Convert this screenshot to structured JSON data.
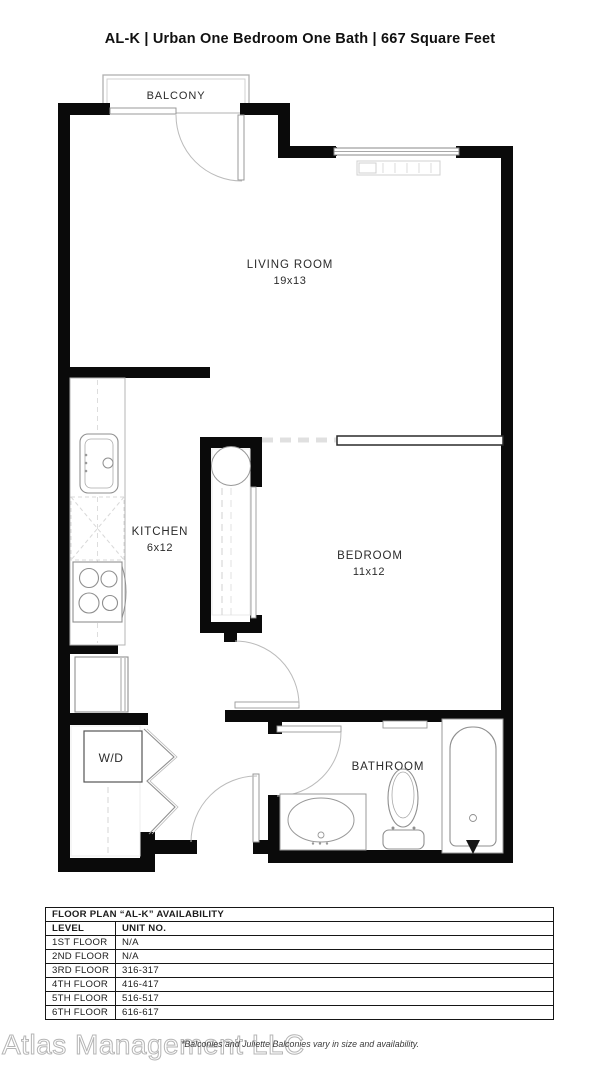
{
  "title": "AL-K | Urban One Bedroom One Bath | 667 Square Feet",
  "plan": {
    "balcony_label": "BALCONY",
    "living_room": {
      "label": "LIVING ROOM",
      "dims": "19x13"
    },
    "kitchen": {
      "label": "KITCHEN",
      "dims": "6x12"
    },
    "bedroom": {
      "label": "BEDROOM",
      "dims": "11x12"
    },
    "wd_label": "W/D",
    "bathroom_label": "BATHROOM"
  },
  "availability": {
    "title": "FLOOR PLAN “AL-K” AVAILABILITY",
    "columns": [
      "LEVEL",
      "UNIT NO."
    ],
    "rows": [
      {
        "level": "1ST FLOOR",
        "unit": "N/A"
      },
      {
        "level": "2ND FLOOR",
        "unit": "N/A"
      },
      {
        "level": "3RD FLOOR",
        "unit": "316-317"
      },
      {
        "level": "4TH FLOOR",
        "unit": "416-417"
      },
      {
        "level": "5TH FLOOR",
        "unit": "516-517"
      },
      {
        "level": "6TH FLOOR",
        "unit": "616-617"
      }
    ]
  },
  "footnote": "*Balconies and Juliette Balconies vary in size and availability.",
  "watermark": "Atlas Management LLC",
  "colors": {
    "wall": "#0a0a0a",
    "fixture": "#8f8f8f",
    "faint": "#d8d8d8",
    "text": "#2b2b2b"
  }
}
